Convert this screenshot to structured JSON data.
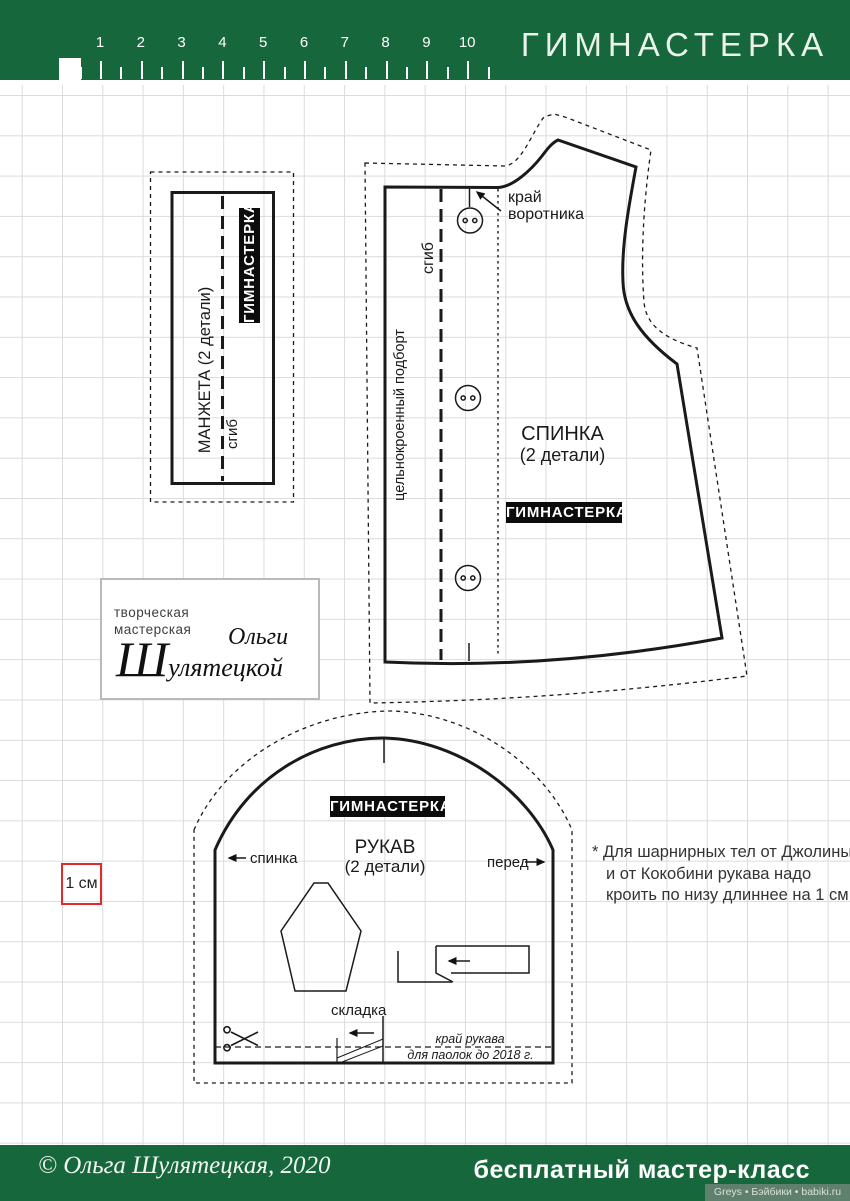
{
  "header": {
    "title": "ГИМНАСТЕРКА",
    "ruler_numbers": [
      "1",
      "2",
      "3",
      "4",
      "5",
      "6",
      "7",
      "8",
      "9",
      "10"
    ]
  },
  "pieces": {
    "cuff": {
      "label": "МАНЖЕТА (2 детали)",
      "fold": "сгиб",
      "tag": "ГИМНАСТЕРКА"
    },
    "back": {
      "name": "СПИНКА",
      "qty": "(2 детали)",
      "tag": "ГИМНАСТЕРКА",
      "fold": "сгиб",
      "facing": "цельнокроенный подборт",
      "collar_note_line1": "край",
      "collar_note_line2": "воротника"
    },
    "sleeve": {
      "tag": "ГИМНАСТЕРКА",
      "name": "РУКАВ",
      "qty": "(2 детали)",
      "back_label": "спинка",
      "front_label": "перед",
      "pleat_label": "складка",
      "cut_note_line1": "край рукава",
      "cut_note_line2": "для паолок до 2018 г."
    }
  },
  "logo": {
    "line1": "творческая",
    "line2": "мастерская",
    "script1": "Ольги",
    "script2": "Шулятецкой"
  },
  "scale_box": "1 см",
  "note_text": "* Для шарнирных тел от Джолины и от Кокобини рукава надо кроить по низу длиннее на 1 см",
  "footer": {
    "copyright": "© Ольга Шулятецкая, 2020",
    "tagline": "бесплатный мастер-класс",
    "watermark": "Greys • Бэйбики • babiki.ru"
  },
  "colors": {
    "green": "#17673c",
    "watermark_bg": "#5f806d",
    "scale_red": "#e02b2b",
    "grid": "#dbdbdb"
  }
}
